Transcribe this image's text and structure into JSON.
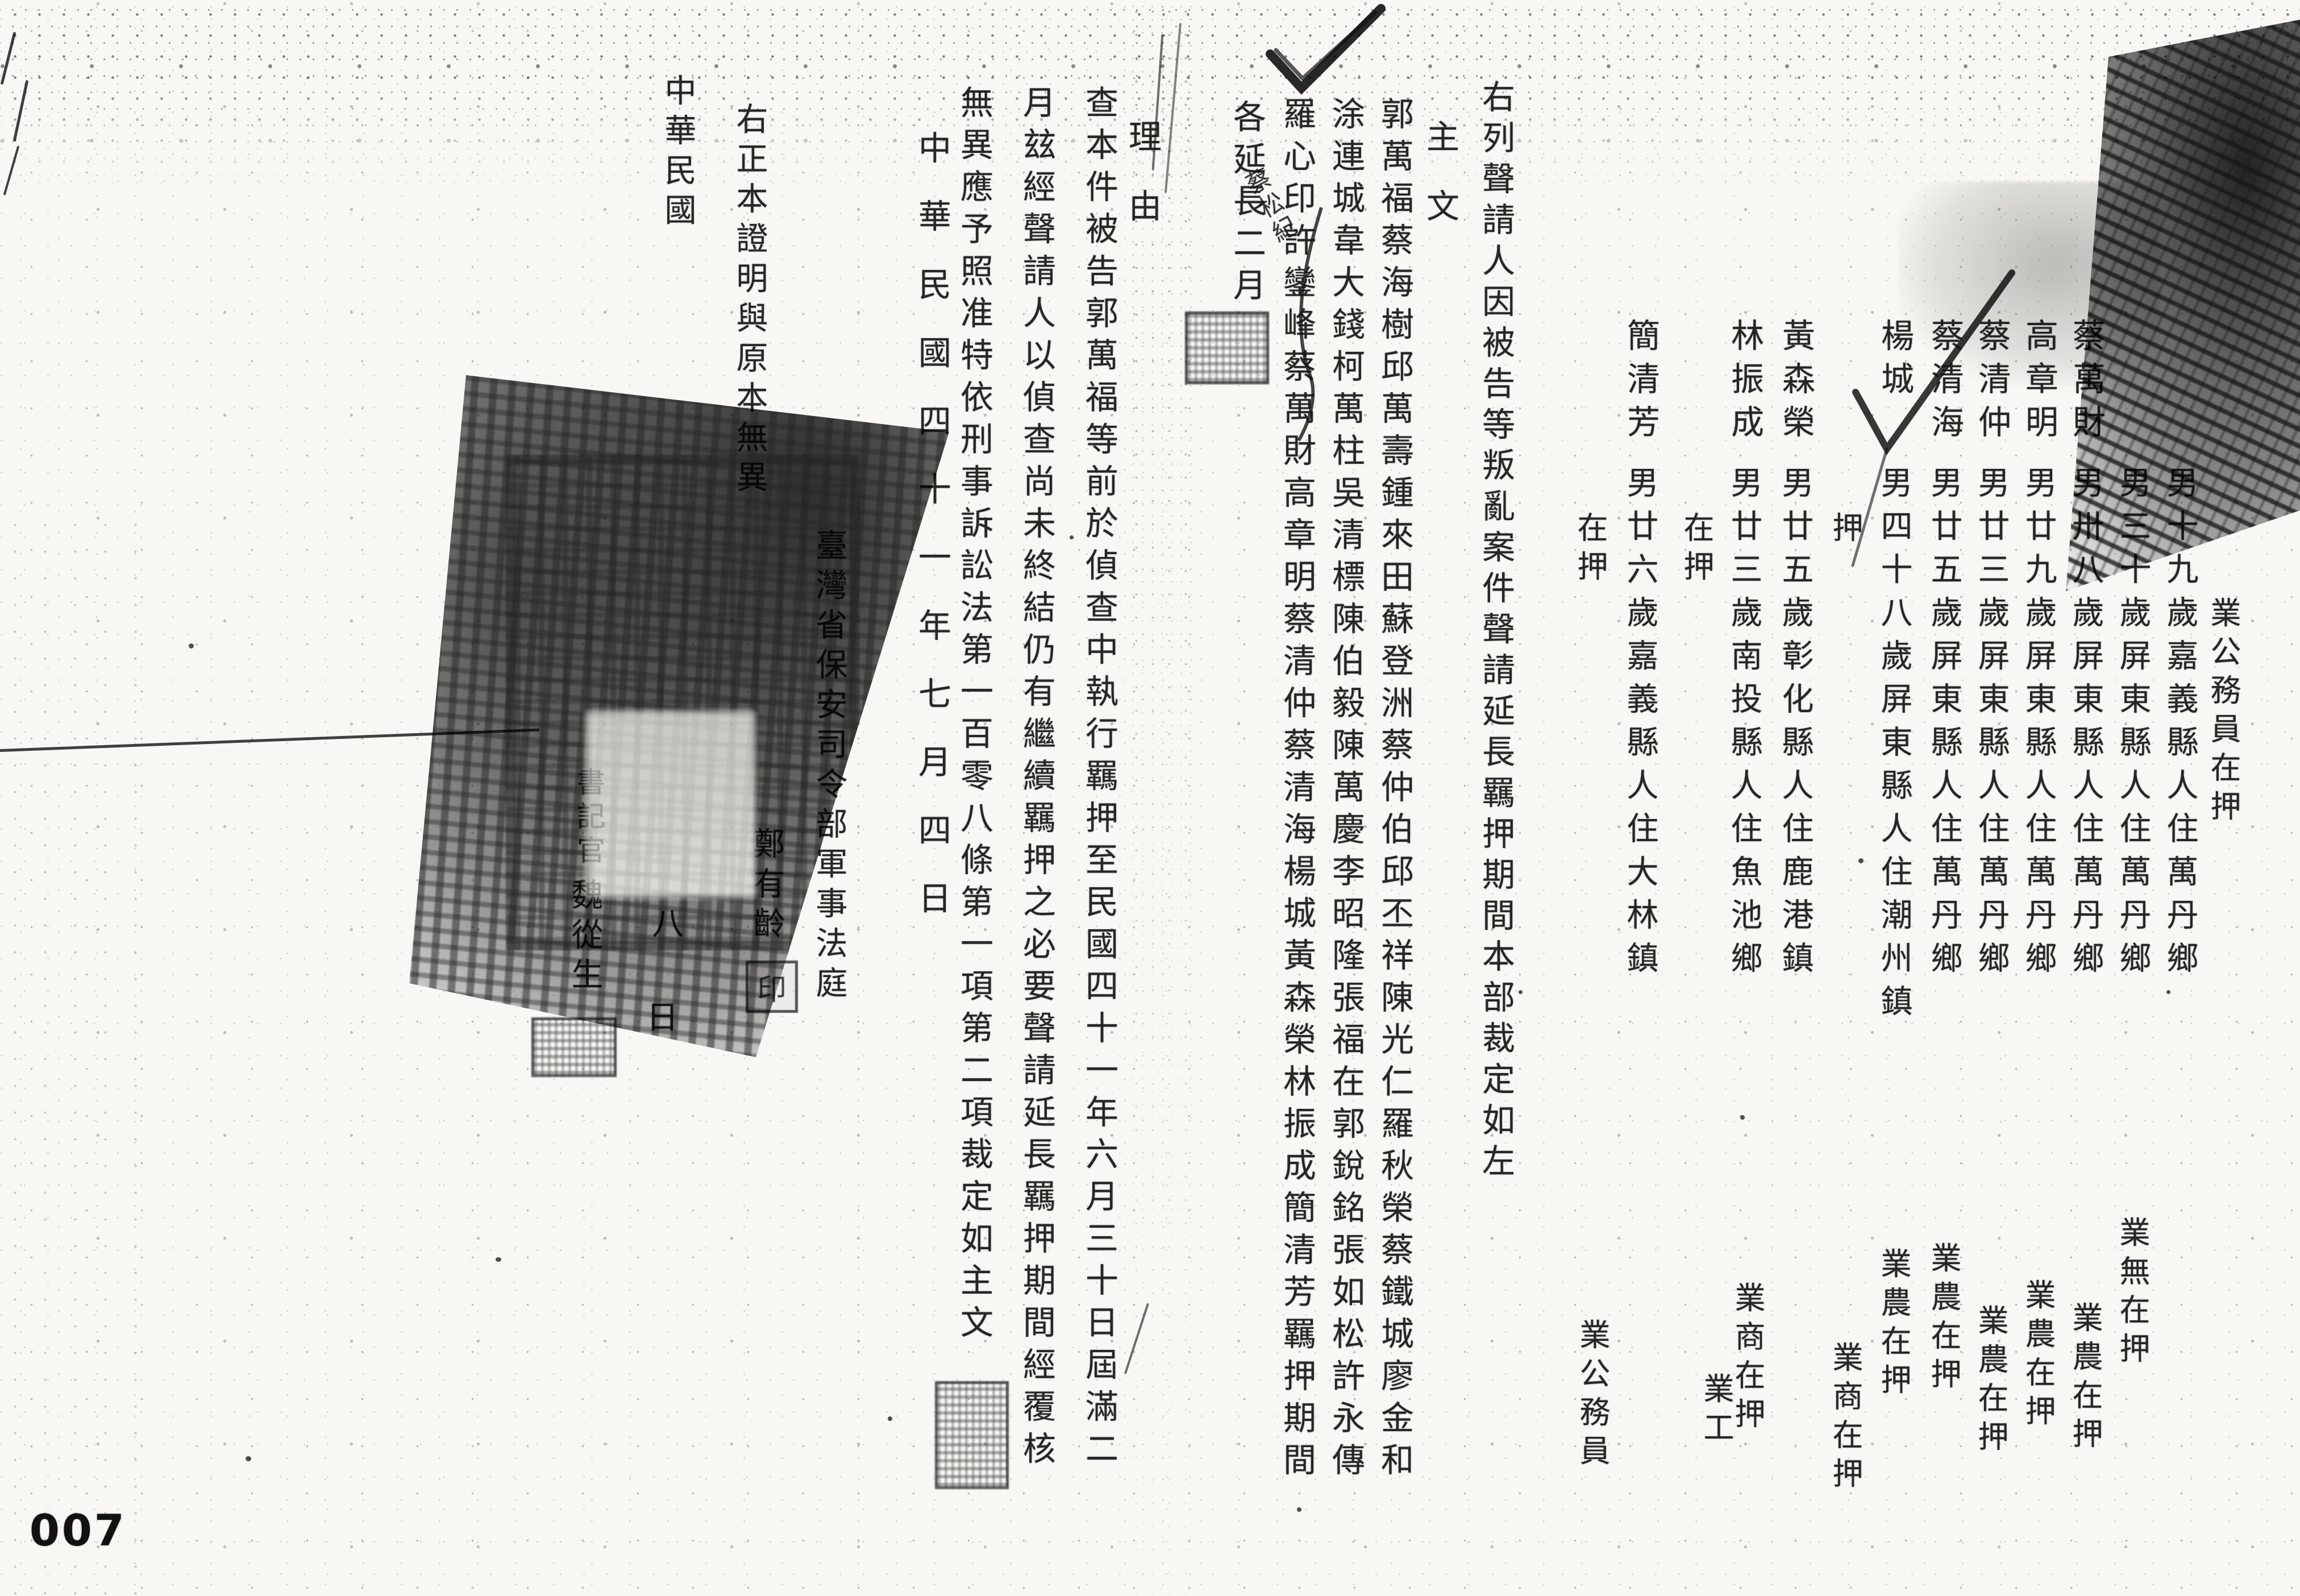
{
  "page_number": "007",
  "right_page": {
    "caption": "右列聲請人因被告等叛亂案件聲請延長羈押期間本部裁定如左",
    "main_header": "主文",
    "main_lines": [
      "郭萬福蔡海樹邱萬壽鍾來田蘇登洲蔡仲伯邱丕祥陳光仁羅秋榮蔡鐵城廖金和",
      "涂連城韋大錢柯萬柱吳清標陳伯毅陳萬慶李昭隆張福在郭銳銘張如松許永傳",
      "羅心印許鑾峰蔡萬財高章明蔡清仲蔡清海楊城黃森榮林振成簡清芳羈押期間"
    ],
    "ruling": "各延長二月",
    "inserted_name": "蔡松紀",
    "persons": [
      {
        "name": "",
        "details": "",
        "status": "業公務員在押",
        "custody": ""
      },
      {
        "name": "",
        "details": "男十九歲嘉義縣人住萬丹鄉",
        "status": "業無在押",
        "custody": ""
      },
      {
        "name": "",
        "details": "男三十歲屏東縣人住萬丹鄉",
        "status": "業農在押",
        "custody": ""
      },
      {
        "name": "蔡萬財",
        "details": "男卅八歲屏東縣人住萬丹鄉",
        "status": "業農在押",
        "custody": ""
      },
      {
        "name": "高章明",
        "details": "男廿九歲屏東縣人住萬丹鄉",
        "status": "業農在押",
        "custody": ""
      },
      {
        "name": "蔡清仲",
        "details": "男廿三歲屏東縣人住萬丹鄉",
        "status": "業農在押",
        "custody": ""
      },
      {
        "name": "蔡清海",
        "details": "男廿五歲屏東縣人住萬丹鄉",
        "status": "業農在押",
        "custody": ""
      },
      {
        "name": "楊城",
        "details": "男四十八歲屏東縣人住潮州鎮",
        "status": "業商在押",
        "custody": "押"
      },
      {
        "name": "黃森榮",
        "details": "男廿五歲彰化縣人住鹿港鎮",
        "status": "業商在押",
        "custody": ""
      },
      {
        "name": "林振成",
        "details": "男廿三歲南投縣人住魚池鄉",
        "status": "業工",
        "custody": "在押"
      },
      {
        "name": "簡清芳",
        "details": "男廿六歲嘉義縣人住大林鎮",
        "status": "業公務員",
        "custody": "在押"
      }
    ]
  },
  "left_page": {
    "reason_header": "理由",
    "reason_lines": [
      "查本件被告郭萬福等前於偵查中執行羈押至民國四十一年六月三十日屆滿二",
      "月玆經聲請人以偵查尚未終結仍有繼續羈押之必要聲請延長羈押期間經覆核",
      "無異應予照准特依刑事訴訟法第一百零八條第一項第二項裁定如主文"
    ],
    "ruling_date": "中華民國四十一年七月四日",
    "court": "臺灣省保安司令部軍事法庭",
    "judge_name": "鄭有齡",
    "judge_seal": "印",
    "certification": "右正本證明與原本無異",
    "cert_date_prefix": "中華民國",
    "cert_date_day": "八",
    "cert_date_day_suffix": "日",
    "clerk_label": "書記官",
    "clerk_name": "魏從生"
  }
}
